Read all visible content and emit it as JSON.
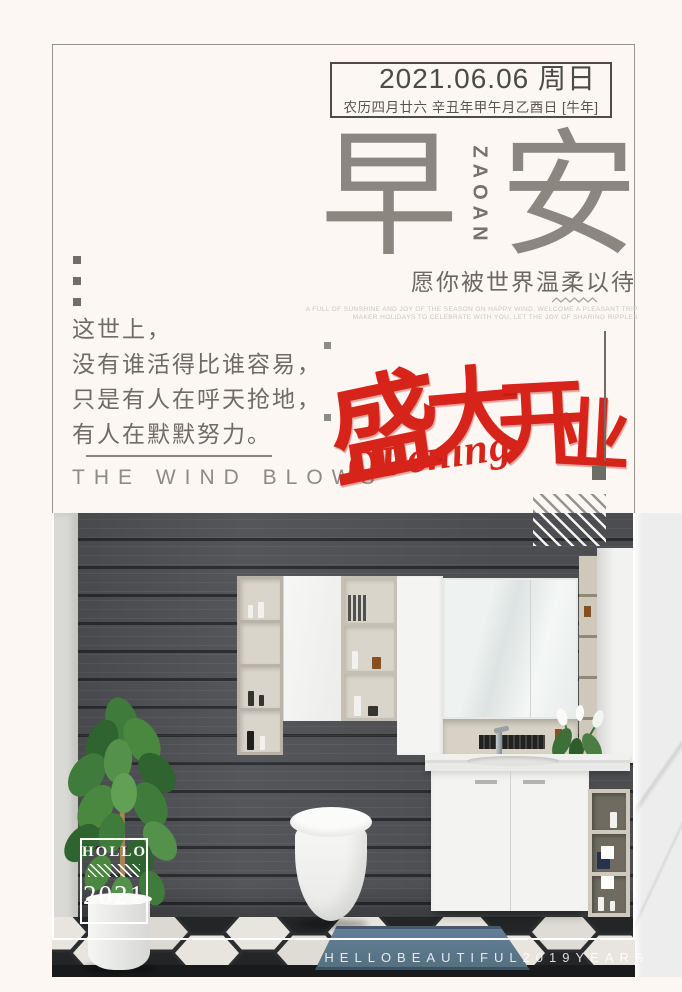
{
  "poster": {
    "date_box": {
      "date": "2021.06.06 周日",
      "lunar_line": "农历四月廿六 辛丑年甲午月乙酉日 [牛年]"
    },
    "masthead": {
      "left_char": "早",
      "right_char": "安",
      "vertical_text": "ZAOAN"
    },
    "blessing": {
      "text": "愿你被世界温柔以待",
      "caption_line1": "A FULL OF SUNSHINE AND JOY OF THE SEASON ON HAPPY WIND, WELCOME A PLEASANT TRIP",
      "caption_line2": "MAKER HOLIDAYS TO CELEBRATE WITH YOU, LET THE JOY OF SHARING RIPPLES"
    },
    "poem": {
      "line1": "这世上，",
      "line2": "没有谁活得比谁容易，",
      "line3": "只是有人在呼天抢地，",
      "line4": "有人在默默努力。"
    },
    "slogan_en": "THE WIND BLOWS",
    "opening": {
      "char1": "盛",
      "char2": "大",
      "char3": "开",
      "char4": "业",
      "script": "OPening"
    },
    "photo": {
      "badge_title": "HOLLO",
      "badge_year": "2021",
      "watermark": "HELLOBEAUTIFUL2019YEARS"
    },
    "colors": {
      "background": "#fcf7f2",
      "accent_red": "#d6241b",
      "title_gray": "#8b8680",
      "text_gray": "#6f6b66",
      "frame_gray": "#95938f",
      "wall_dark": "#3f4144",
      "rug_blue": "#5d7a8e"
    }
  }
}
